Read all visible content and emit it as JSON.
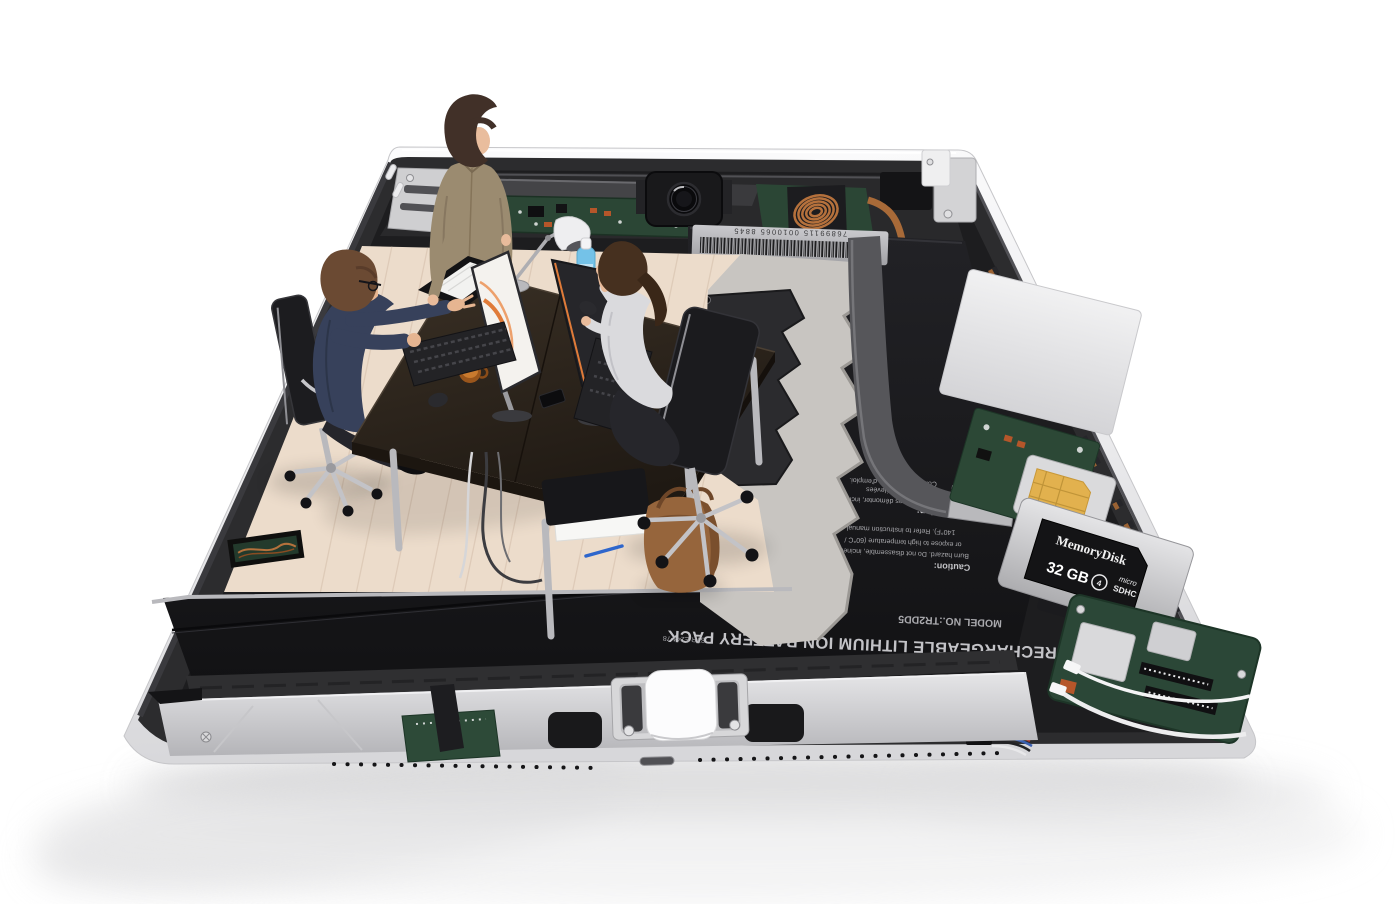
{
  "battery": {
    "name_label": "RECHARGEABLE LITHIUM ION BATTERY PACK",
    "part_code": "STR.E244-78",
    "model": "MODEL NO.:TR2DD5",
    "spec": "3.7 V / 3080 mAh / 11",
    "part_number_label": "P/N:",
    "caution_title": "Caution:",
    "caution_line1": "Burn hazard. Do not disassemble, incinerate",
    "caution_line2": "or expose to high temperature (60°C /",
    "caution_line3": "140°F). Refer to instruction manual.",
    "attention_title": "Attention:",
    "attention_line1": "brûlures. Ne pas démonter, incinérer",
    "attention_line2": "les températures élevées",
    "attention_line3": "Consultez le mode d'emploi."
  },
  "regulatory": {
    "barcode_number": "76899115 0010065 8845",
    "made_in": "MADE IN JAPAN",
    "ce_mark": "CE",
    "fcc_mark": "FC",
    "ul_mark": "UL"
  },
  "memory_card": {
    "brand": "MemoryDisk",
    "capacity": "32 GB",
    "class_mark": "4",
    "type_line1": "micro",
    "type_line2": "SDHC"
  },
  "colors": {
    "aluminum_shell": "#e9e9eb",
    "frame_dark": "#2c2c2e",
    "battery_black": "#17171a",
    "pcb_green": "#2b4635",
    "copper": "#a86a38",
    "sim_gold": "#e2b14e",
    "wood_floor": "#ecdccb",
    "felt_mat": "#c8c5c1",
    "desk_wood": "#2a2119",
    "monitor_accent_orange": "#e07b39",
    "bottle_blue": "#74c2e8",
    "cable_white": "#efefef"
  }
}
